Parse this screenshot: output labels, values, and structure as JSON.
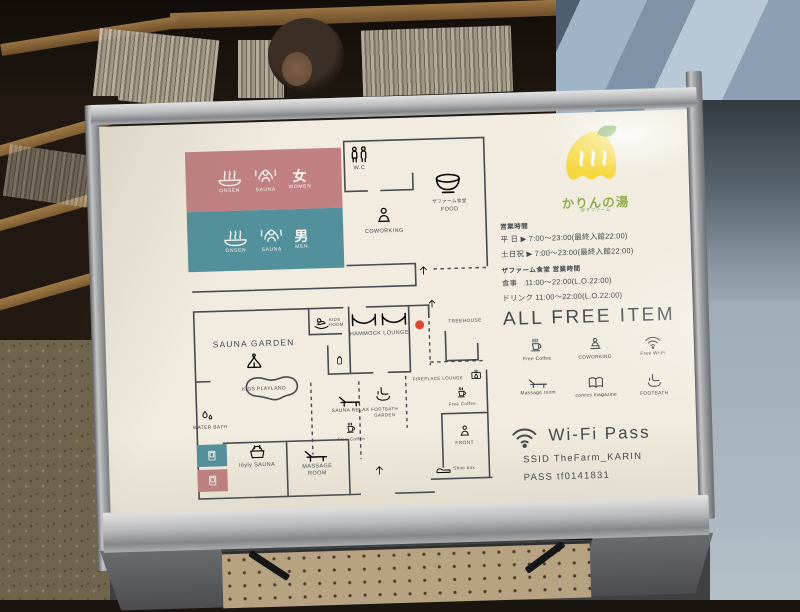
{
  "colors": {
    "cream": "#f1ecdf",
    "ink": "#45484d",
    "pink": "#c18182",
    "teal": "#52909b",
    "accent_red": "#e0472f",
    "logo_yellow": "#f4d83e",
    "leaf_green": "#6aa648",
    "logo_text_green": "#8fae4e"
  },
  "sign": {
    "brand": {
      "logo_text": "かりんの湯",
      "tagline": "＠ザファーム"
    },
    "zones": {
      "women": {
        "onsen": "ONSEN",
        "sauna": "SAUNA",
        "kanji": "女",
        "label": "WOMEN"
      },
      "men": {
        "onsen": "ONSEN",
        "sauna": "SAUNA",
        "kanji": "男",
        "label": "MEN"
      }
    },
    "map": {
      "wc": "W.C",
      "food_jp": "ザファーム食堂",
      "food": "FOOD",
      "coworking": "COWORKING",
      "sauna_garden": "SAUNA GARDEN",
      "kids_playland": "KIDS PLAYLAND",
      "water_bath": "WATER BATH",
      "loyly_sauna": "löyly SAUNA",
      "massage_room": "MASSAGE ROOM",
      "kids_room": "KIDS ROOM",
      "hammock_lounge": "HAMMOCK LOUNGE",
      "treehouse": "TREEHOUSE",
      "fireplace_lounge": "FIREPLACE LOUNGE",
      "free_coffee": "Free Coffee",
      "sauna_relax": "SAUNA RELAX",
      "footbath_garden": "FOOTBATH GARDEN",
      "front": "FRONT",
      "shoe_box": "Shoe box"
    },
    "hours": {
      "title": "営業時間",
      "weekday": "平 日 ▶ 7:00〜23:00(最終入館22:00)",
      "weekend": "土日祝 ▶ 7:00〜23:00(最終入館22:00)",
      "restaurant_title": "ザファーム食堂 営業時間",
      "meal": "食事　11:00〜22:00(L.O.22:00)",
      "drink": "ドリンク 11:00〜22:00(L.O.22:00)"
    },
    "free_items": {
      "title": "ALL FREE ITEM",
      "items": [
        {
          "label": "Free Coffee",
          "icon": "coffee-icon"
        },
        {
          "label": "COWORKING",
          "icon": "coworking-icon"
        },
        {
          "label": "Free Wi-Fi",
          "icon": "wifi-icon"
        },
        {
          "label": "Massage room",
          "icon": "massage-lounger-icon"
        },
        {
          "label": "comics magazine",
          "icon": "comics-book-icon"
        },
        {
          "label": "FOOTBATH",
          "icon": "footbath-icon"
        }
      ]
    },
    "wifi": {
      "title": "Wi-Fi Pass",
      "ssid": "SSID TheFarm_KARIN",
      "pass": "PASS tf0141831"
    }
  }
}
